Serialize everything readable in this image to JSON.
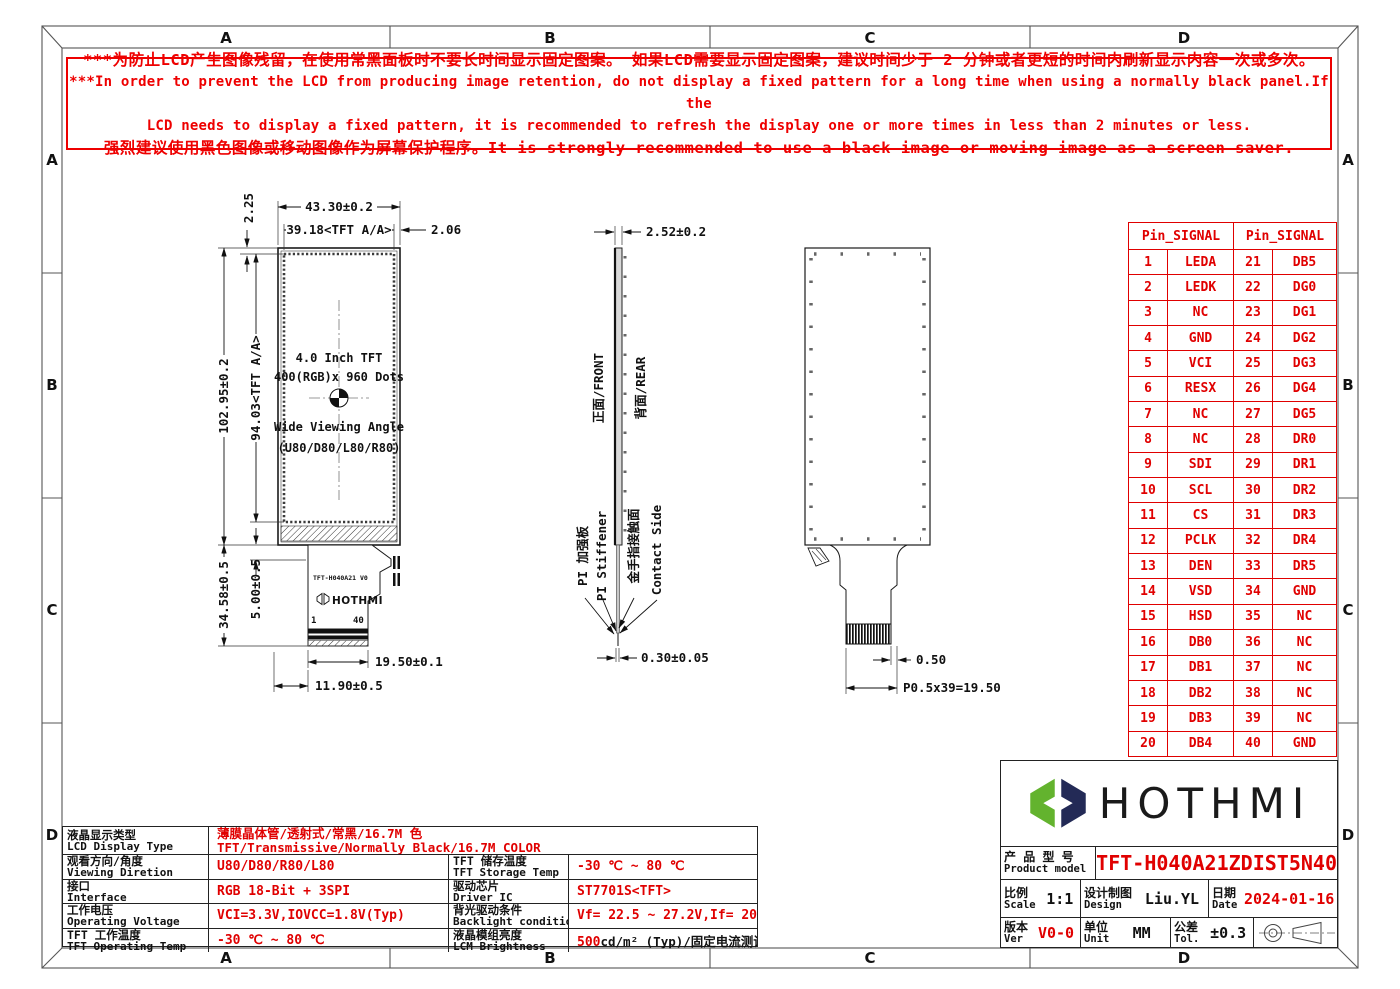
{
  "colors": {
    "red": "#e00000",
    "line": "#1a1a1a",
    "logo_green": "#63b32e",
    "logo_navy": "#232a56"
  },
  "frame": {
    "zones": [
      "A",
      "B",
      "C",
      "D"
    ]
  },
  "warning": {
    "line1": "***为防止LCD产生图像残留，在使用常黑面板时不要长时间显示固定图案。 如果LCD需要显示固定图案，建议时间少于 2 分钟或者更短的时间内刷新显示内容一次或多次。",
    "line2": "***In order to prevent the LCD from producing image retention, do not display a fixed pattern for a long time when using a normally black panel.If the",
    "line3": "LCD needs to display a fixed pattern, it is recommended to refresh the display one or more times in less than 2 minutes or less.",
    "line4": "强烈建议使用黑色图像或移动图像作为屏幕保护程序。It is strongly recommended to use a black image or moving image as a screen saver."
  },
  "front_view": {
    "panel_text": [
      "4.0 Inch TFT",
      "400(RGB)x 960 Dots",
      "Wide Viewing Angle",
      "(U80/D80/L80/R80)"
    ],
    "dims": {
      "width_total": "43.30±0.2",
      "width_aa": "39.18<TFT A/A>",
      "right_margin": "2.06",
      "top_margin": "2.25",
      "height_total": "102.95±0.2",
      "height_aa": "94.03<TFT A/A>",
      "tail_length": "34.58±0.5",
      "ledge": "5.00±0.5",
      "connector_width": "19.50±0.1",
      "tail_offset": "11.90±0.5"
    },
    "fpc": {
      "part_no": "TFT-H040A21 V0",
      "brand": "HOTHMI",
      "pin_first": "1",
      "pin_last": "40"
    }
  },
  "side_view": {
    "dims": {
      "thickness": "2.52±0.2",
      "fpc_thickness": "0.30±0.05"
    },
    "labels": {
      "front": "正面/FRONT",
      "rear": "背面/REAR",
      "stiffener_cn": "PI 加强板",
      "stiffener_en": "PI Stiffener",
      "contact_cn": "金手指接触面",
      "contact_en": "Contact Side"
    }
  },
  "rear_view": {
    "dims": {
      "pad_pitch": "0.50",
      "pitch_total": "P0.5x39=19.50"
    }
  },
  "pin_table": {
    "header": "Pin_SIGNAL",
    "rows": [
      {
        "p1": "1",
        "s1": "LEDA",
        "p2": "21",
        "s2": "DB5"
      },
      {
        "p1": "2",
        "s1": "LEDK",
        "p2": "22",
        "s2": "DG0"
      },
      {
        "p1": "3",
        "s1": "NC",
        "p2": "23",
        "s2": "DG1"
      },
      {
        "p1": "4",
        "s1": "GND",
        "p2": "24",
        "s2": "DG2"
      },
      {
        "p1": "5",
        "s1": "VCI",
        "p2": "25",
        "s2": "DG3"
      },
      {
        "p1": "6",
        "s1": "RESX",
        "p2": "26",
        "s2": "DG4"
      },
      {
        "p1": "7",
        "s1": "NC",
        "p2": "27",
        "s2": "DG5"
      },
      {
        "p1": "8",
        "s1": "NC",
        "p2": "28",
        "s2": "DR0"
      },
      {
        "p1": "9",
        "s1": "SDI",
        "p2": "29",
        "s2": "DR1"
      },
      {
        "p1": "10",
        "s1": "SCL",
        "p2": "30",
        "s2": "DR2"
      },
      {
        "p1": "11",
        "s1": "CS",
        "p2": "31",
        "s2": "DR3"
      },
      {
        "p1": "12",
        "s1": "PCLK",
        "p2": "32",
        "s2": "DR4"
      },
      {
        "p1": "13",
        "s1": "DEN",
        "p2": "33",
        "s2": "DR5"
      },
      {
        "p1": "14",
        "s1": "VSD",
        "p2": "34",
        "s2": "GND"
      },
      {
        "p1": "15",
        "s1": "HSD",
        "p2": "35",
        "s2": "NC"
      },
      {
        "p1": "16",
        "s1": "DB0",
        "p2": "36",
        "s2": "NC"
      },
      {
        "p1": "17",
        "s1": "DB1",
        "p2": "37",
        "s2": "NC"
      },
      {
        "p1": "18",
        "s1": "DB2",
        "p2": "38",
        "s2": "NC"
      },
      {
        "p1": "19",
        "s1": "DB3",
        "p2": "39",
        "s2": "NC"
      },
      {
        "p1": "20",
        "s1": "DB4",
        "p2": "40",
        "s2": "GND"
      }
    ]
  },
  "spec_table": {
    "row1": {
      "label_cn": "液晶显示类型",
      "label_en": "LCD Display Type",
      "value_cn": "薄膜晶体管/透射式/常黑/16.7M 色",
      "value_en": "TFT/Transmissive/Normally Black/16.7M COLOR"
    },
    "rows": [
      {
        "l1cn": "观看方向/角度",
        "l1en": "Viewing Diretion",
        "v1": "U80/D80/R80/L80",
        "l2cn": "TFT 储存温度",
        "l2en": "TFT Storage Temp",
        "v2": "-30 ℃ ~ 80 ℃"
      },
      {
        "l1cn": "接口",
        "l1en": "Interface",
        "v1": "RGB 18-Bit + 3SPI",
        "l2cn": "驱动芯片",
        "l2en": "Driver IC",
        "v2": "ST7701S<TFT>"
      },
      {
        "l1cn": "工作电压",
        "l1en": "Operating Voltage",
        "v1": "VCI=3.3V,IOVCC=1.8V(Typ)",
        "l2cn": "背光驱动条件",
        "l2en": "Backlight conditions",
        "v2": "Vf= 22.5 ~ 27.2V,If= 20 mA"
      },
      {
        "l1cn": "TFT 工作温度",
        "l1en": "TFT Operating Temp",
        "v1": "-30 ℃ ~ 80 ℃",
        "l2cn": "液晶模组亮度",
        "l2en": "LCM Brightness",
        "v2_red": "500",
        "v2_black": " cd/m² (Typ)/固定电流测试"
      }
    ]
  },
  "title_block": {
    "brand": "HOTHMI",
    "product_label_cn": "产 品 型 号",
    "product_label_en": "Product model",
    "product_model": "TFT-H040A21ZDIST5N40",
    "scale_label_cn": "比例",
    "scale_label_en": "Scale",
    "scale": "1:1",
    "design_label_cn": "设计制图",
    "design_label_en": "Design",
    "designer": "Liu.YL",
    "date_label_cn": "日期",
    "date_label_en": "Date",
    "date": "2024-01-16",
    "ver_label_cn": "版本",
    "ver_label_en": "Ver",
    "version": "V0-0",
    "unit_label_cn": "单位",
    "unit_label_en": "Unit",
    "unit": "MM",
    "tol_label_cn": "公差",
    "tol_label_en": "Tol.",
    "tolerance": "±0.3"
  }
}
